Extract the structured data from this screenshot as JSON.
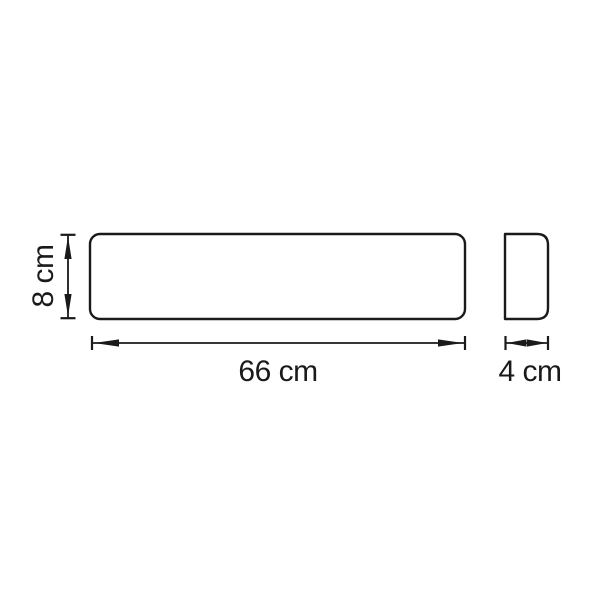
{
  "page": {
    "background": "#ffffff"
  },
  "drawing": {
    "line_color": "#1a1a1a",
    "views": {
      "front": {
        "width_dimension": {
          "label": "66 cm"
        },
        "height_dimension": {
          "label": "8 cm"
        }
      },
      "side": {
        "depth_dimension": {
          "label": "4 cm"
        }
      }
    }
  }
}
